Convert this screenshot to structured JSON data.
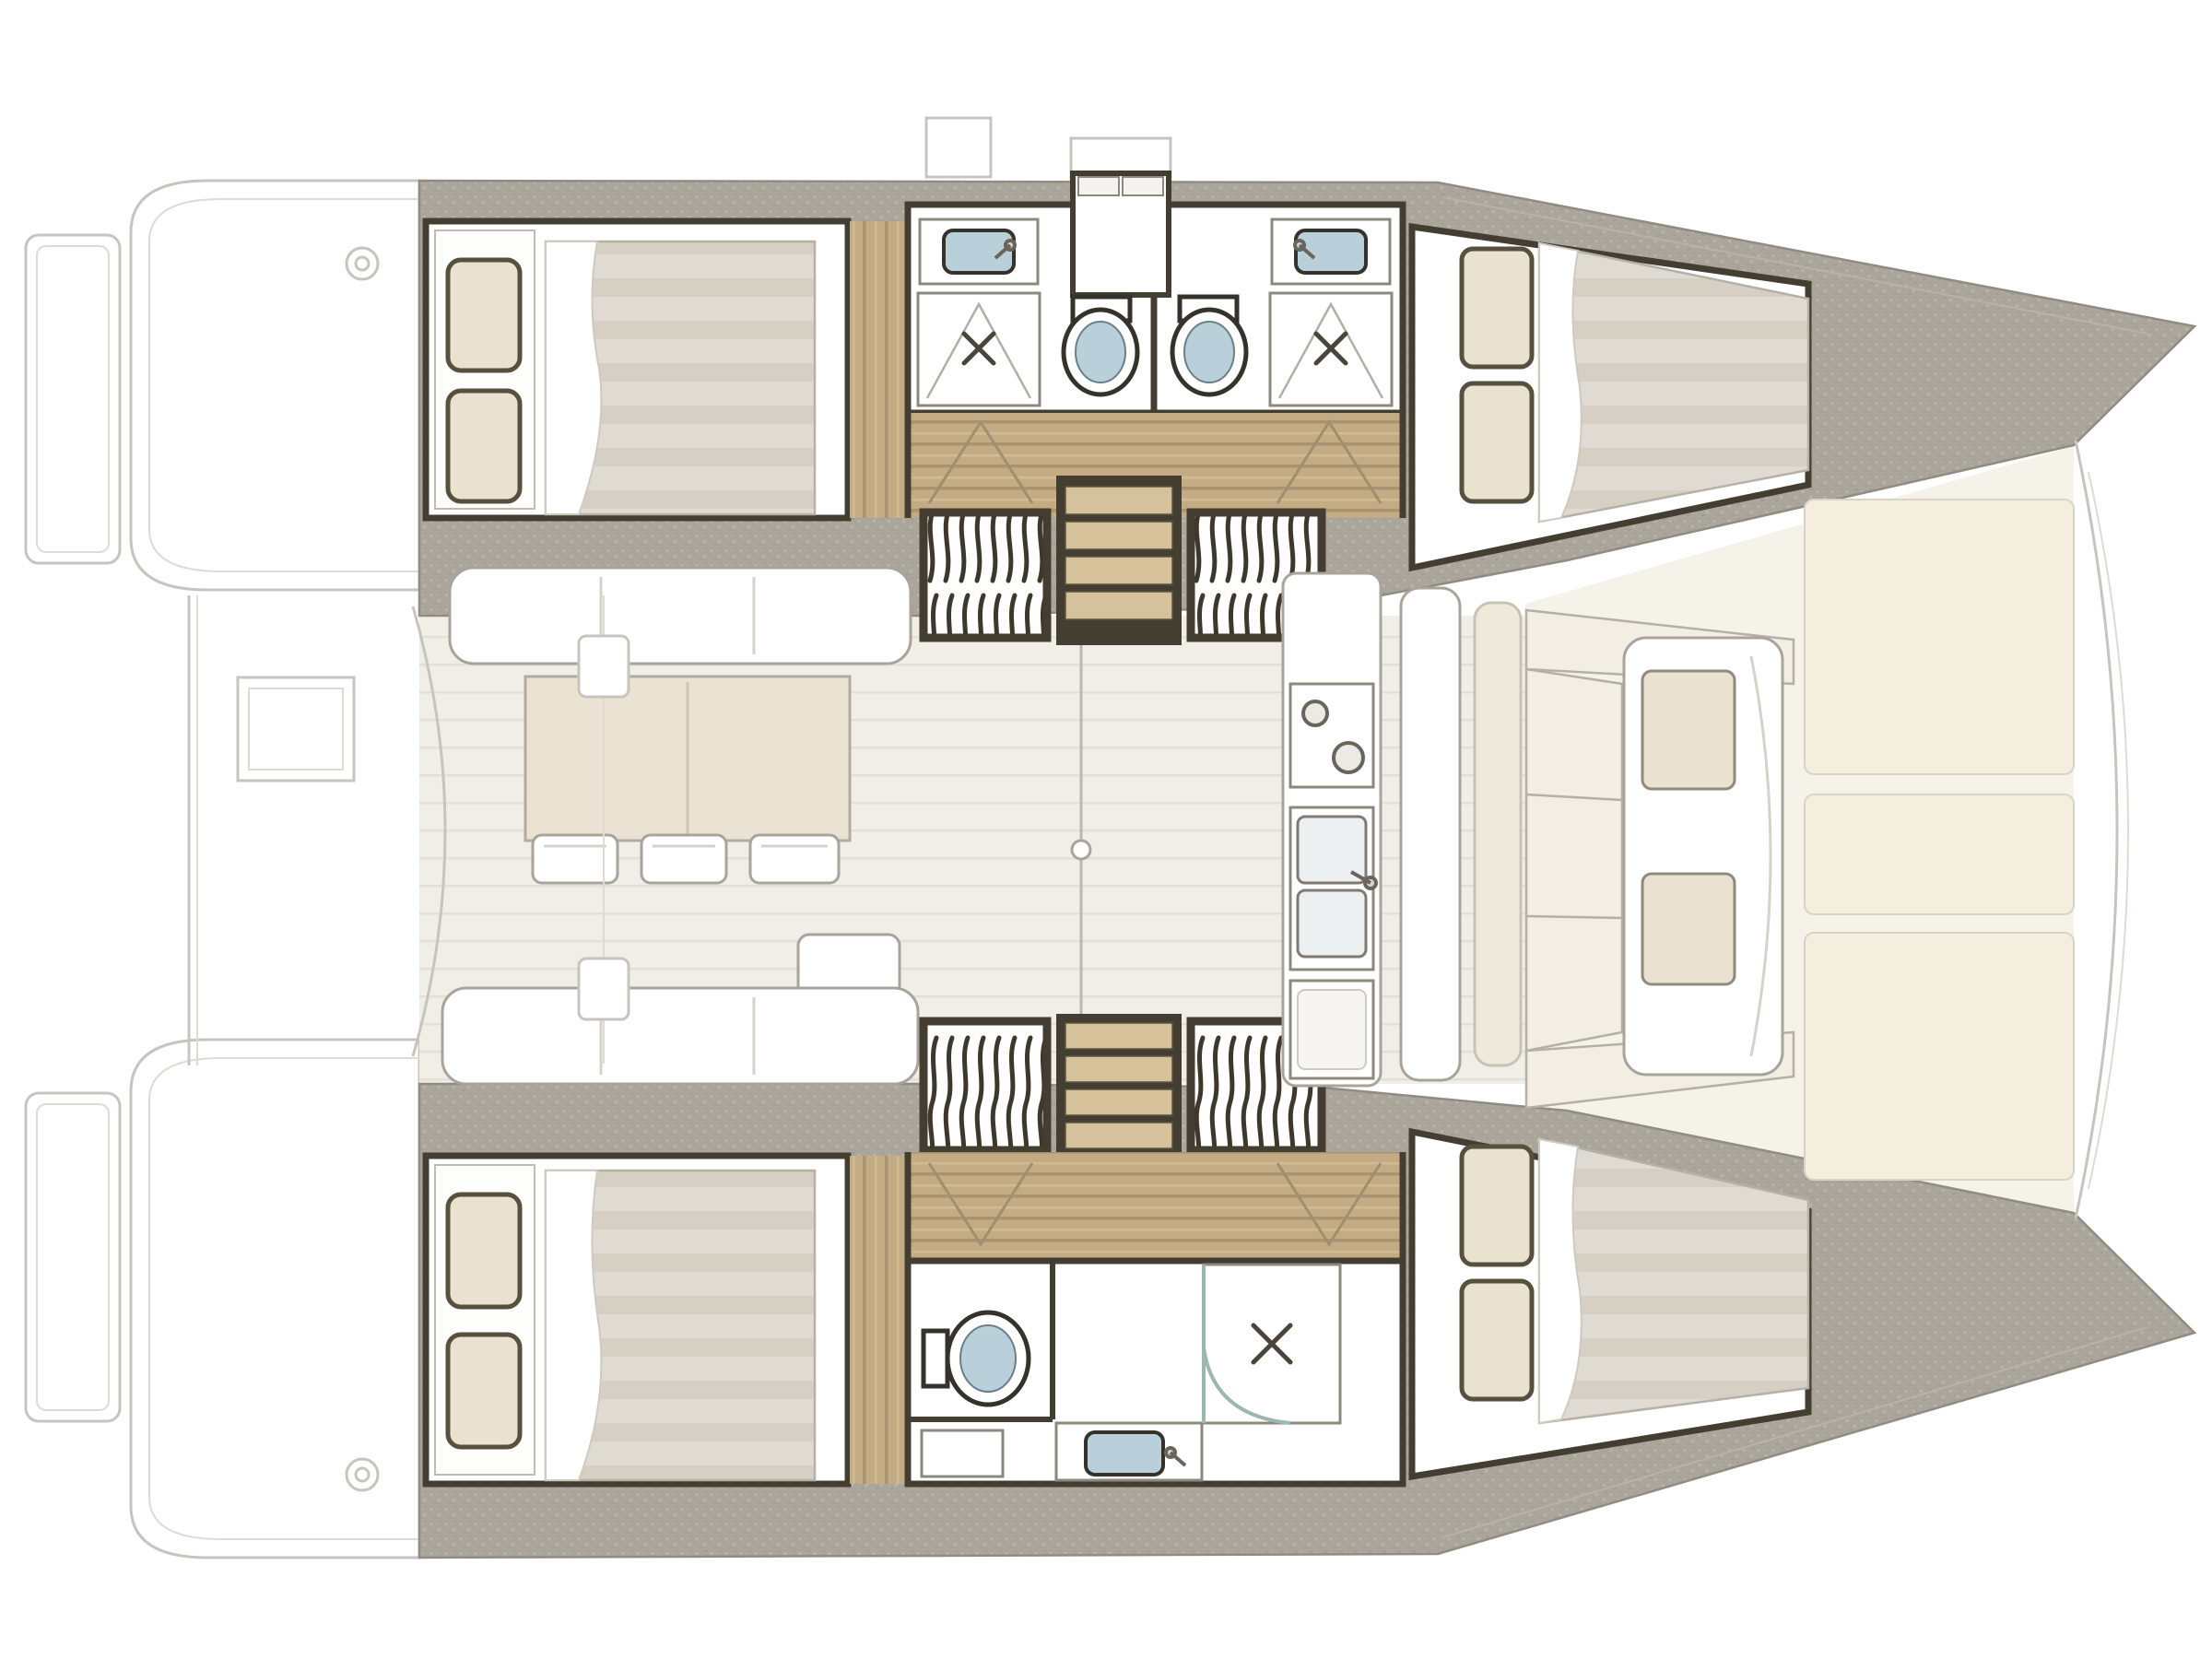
{
  "meta": {
    "title": "Catamaran interior deck plan",
    "view": "top-down floor plan",
    "bow_direction": "right",
    "stern_direction": "left"
  },
  "colors": {
    "background": "#ffffff",
    "ghost_line": "#c7c4bd",
    "hull_edge": "#918c82",
    "deck": "#aba69c",
    "deck_dot": "#b9b4ab",
    "deck_dot_dark": "#9d978c",
    "wall": "#443d31",
    "wood": "#c3ab84",
    "wood_grain": "#ab9270",
    "wood_light": "#d2bb92",
    "saloon_floor": "#f1eee8",
    "saloon_floor_line": "#e4e0d8",
    "forward_floor": "#f5f2ea",
    "furniture_outline": "#a9a49b",
    "mattress": "#e0dbd2",
    "mattress_stripe": "#cdc7bb",
    "pillow": "#e9e2d1",
    "pillow_edge": "#57503f",
    "table": "#eae2d2",
    "cream_cushion": "#e9e2d0",
    "sunpad_panel": "#f3eede",
    "fixture_blue": "#b9cfda",
    "step_tread": "#d5c29a",
    "shower_glass": "#9bb7ae",
    "door_arc": "#a08e6d"
  },
  "inventory": {
    "hulls": [
      {
        "side": "port",
        "position": "top",
        "cabins": [
          {
            "name": "aft double cabin",
            "bed": "double",
            "pillows": 2
          },
          {
            "name": "forward double cabin",
            "bed": "double",
            "pillows": 2
          }
        ],
        "heads": [
          {
            "name": "aft head",
            "fixtures": [
              "washbasin",
              "toilet",
              "shower"
            ]
          },
          {
            "name": "forward head",
            "fixtures": [
              "washbasin",
              "toilet",
              "shower"
            ]
          }
        ],
        "companionway": {
          "steps": 4,
          "louvered_panels": 2
        }
      },
      {
        "side": "starboard",
        "position": "bottom",
        "cabins": [
          {
            "name": "aft double cabin",
            "bed": "double",
            "pillows": 2
          },
          {
            "name": "forward double cabin",
            "bed": "double",
            "pillows": 2
          }
        ],
        "heads": [
          {
            "name": "shared head",
            "fixtures": [
              "toilet",
              "washbasin",
              "shower"
            ]
          }
        ],
        "companionway": {
          "steps": 4,
          "louvered_panels": 2
        }
      }
    ],
    "saloon": {
      "sofas": [
        {
          "name": "forward sofa",
          "seat_sections": 3
        },
        {
          "name": "aft sofa",
          "seat_sections": 3,
          "chaise_extension": true
        }
      ],
      "dining_table": {
        "leaves": 2
      },
      "stools": 3,
      "sliding_door_handles": 1
    },
    "galley": {
      "units": [
        "stove",
        "double sink",
        "cabinet"
      ],
      "stove_burners": 2,
      "sink_basins": 2
    },
    "foredeck": {
      "settee_cushions": 2,
      "perimeter_bench_sections": 3,
      "sunpad_panels": 3
    },
    "aft_deck": {
      "swim_platforms": 2,
      "cockpit_table": 1,
      "deck_fittings": 2,
      "winches": 2
    }
  }
}
